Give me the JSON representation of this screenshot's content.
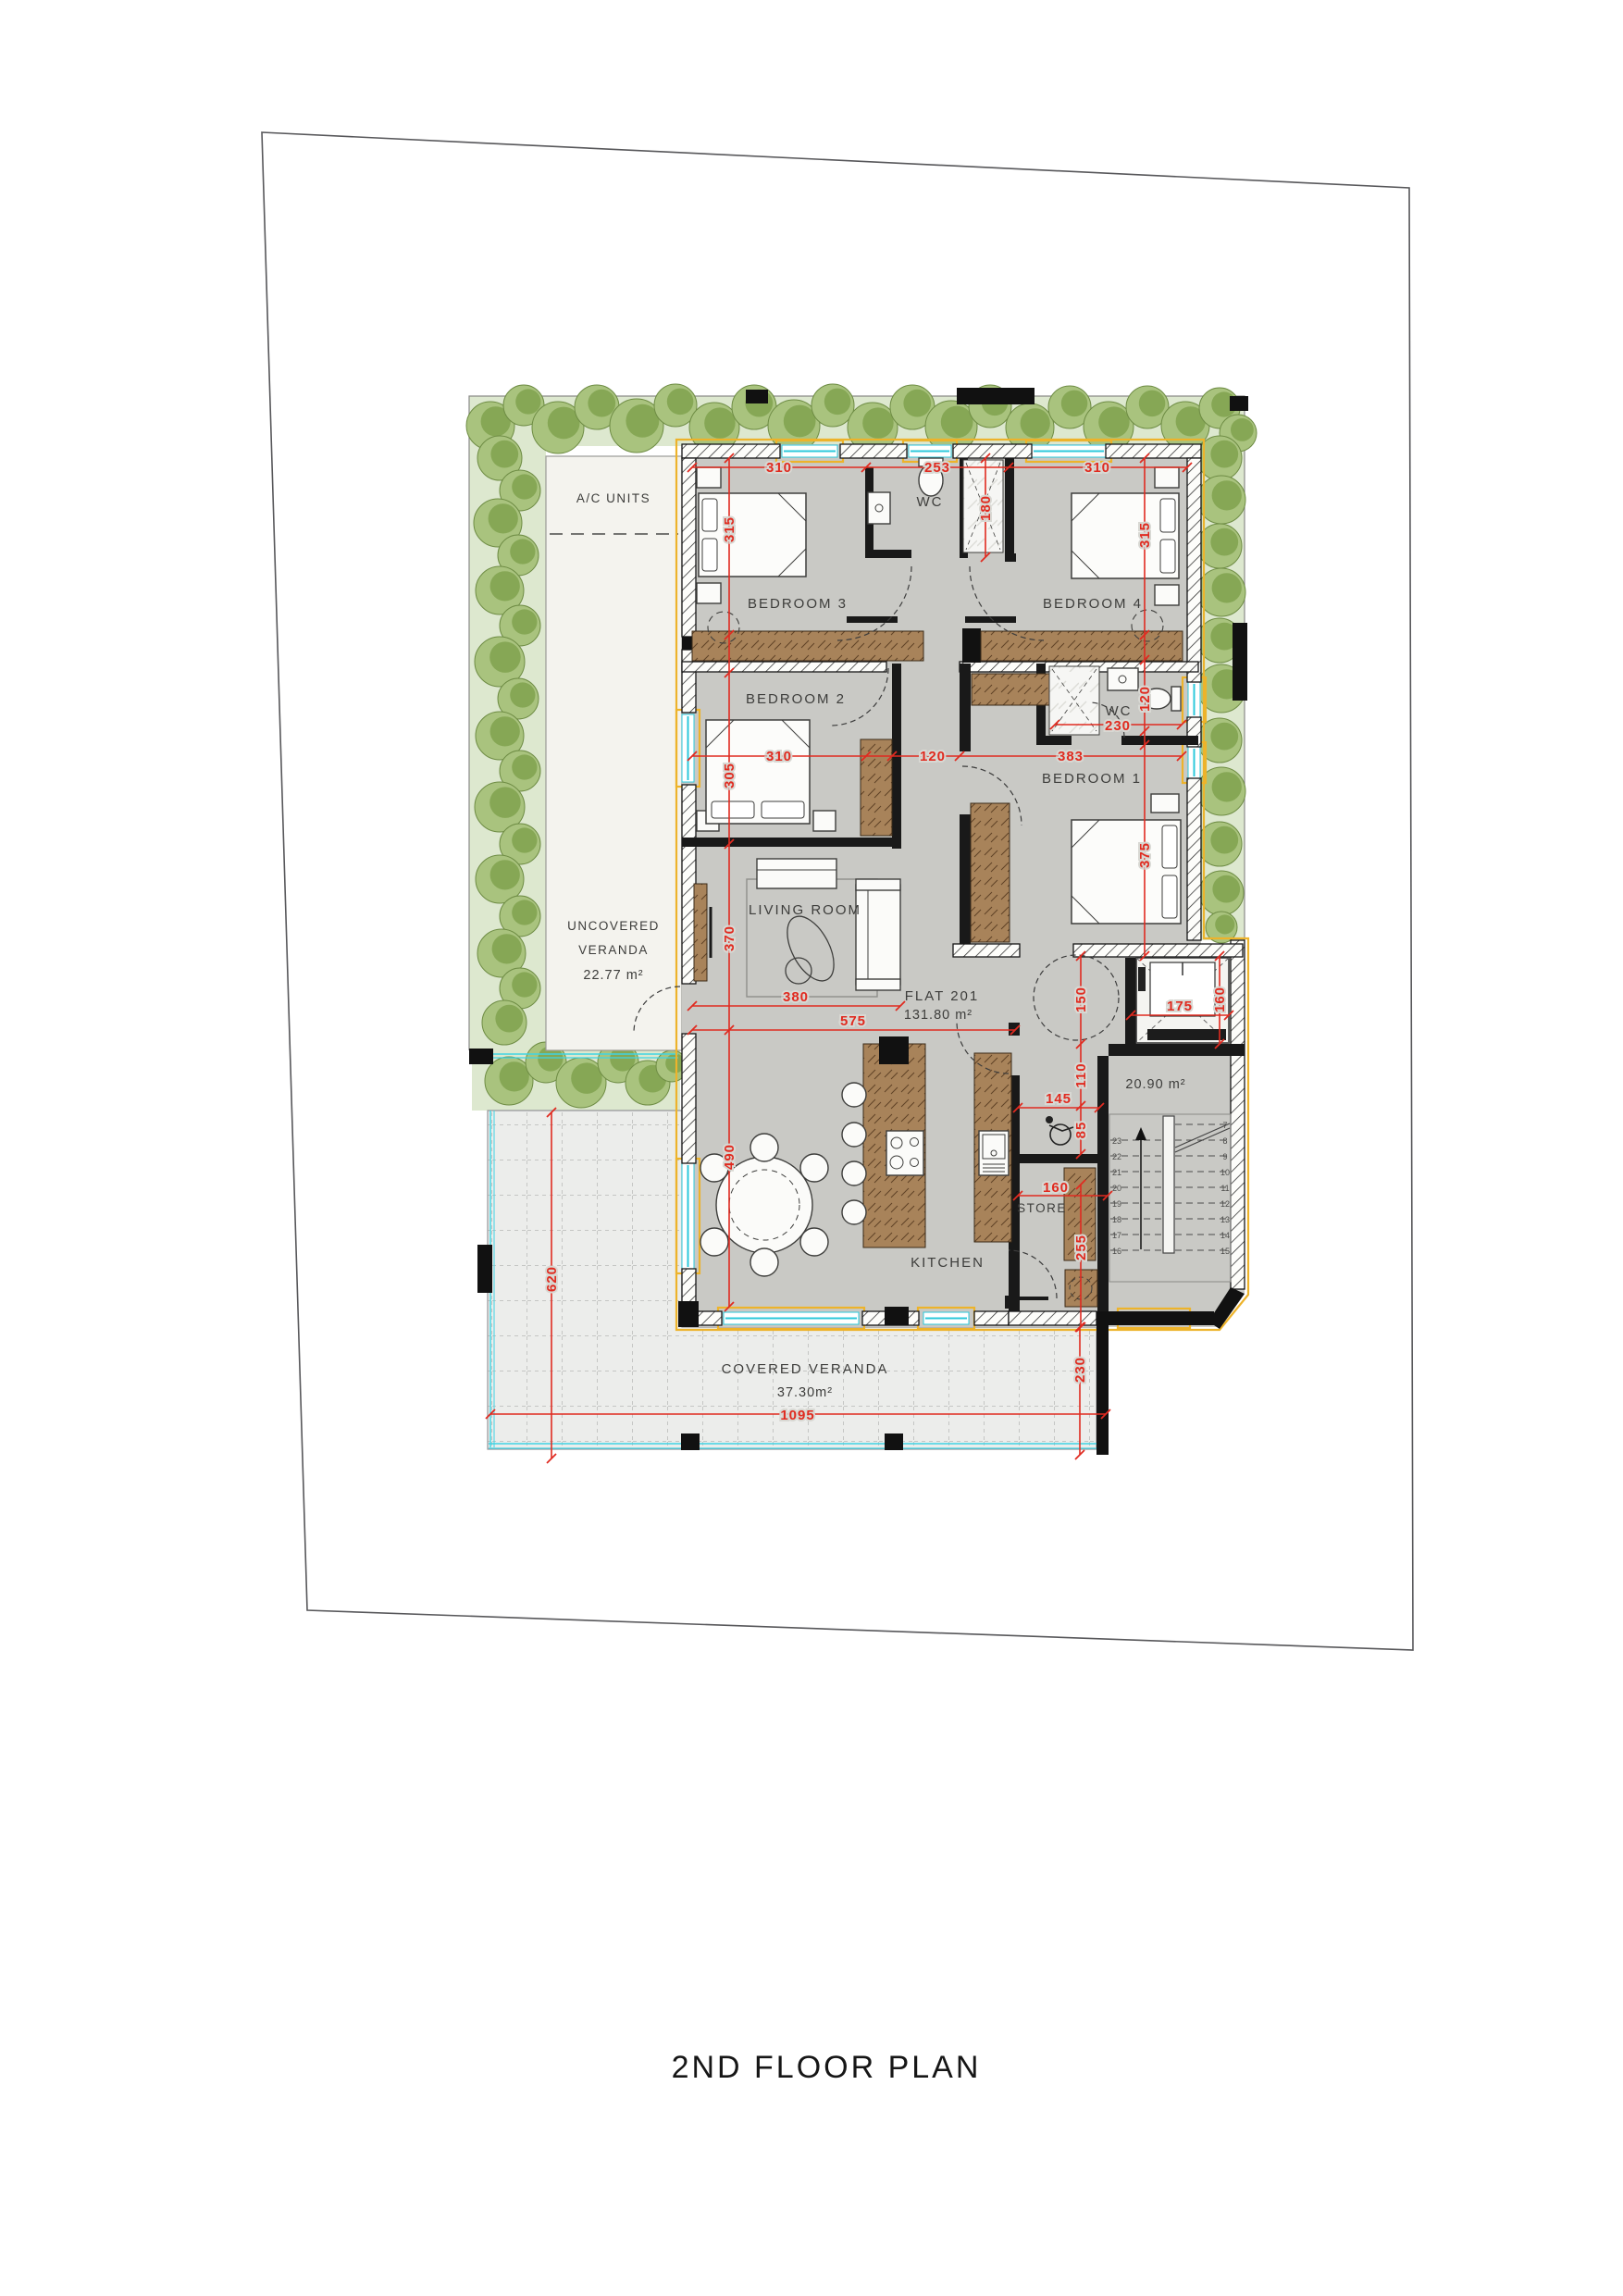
{
  "title": "2ND FLOOR PLAN",
  "flat": {
    "name": "FLAT 201",
    "area": "131.80 m²"
  },
  "rooms": {
    "bedroom1": "BEDROOM 1",
    "bedroom2": "BEDROOM 2",
    "bedroom3": "BEDROOM 3",
    "bedroom4": "BEDROOM 4",
    "living_room": "LIVING ROOM",
    "kitchen": "KITCHEN",
    "store": "STORE",
    "wc_top": "WC",
    "wc_right": "WC",
    "ac_units": "A/C UNITS",
    "uncovered_veranda": {
      "line1": "UNCOVERED",
      "line2": "VERANDA",
      "area": "22.77 m²"
    },
    "covered_veranda": {
      "label": "COVERED VERANDA",
      "area": "37.30m²"
    },
    "stair_hall": {
      "area": "20.90 m²"
    }
  },
  "dims": {
    "d310a": "310",
    "d253": "253",
    "d310b": "310",
    "d315a": "315",
    "d180": "180",
    "d315b": "315",
    "d230wc": "230",
    "d120wc": "120",
    "d310c": "310",
    "d120h": "120",
    "d383": "383",
    "d305": "305",
    "d375": "375",
    "d370": "370",
    "d380": "380",
    "d575": "575",
    "d150": "150",
    "d110": "110",
    "d85": "85",
    "d145": "145",
    "d160s": "160",
    "d255": "255",
    "d175": "175",
    "d160e": "160",
    "d490": "490",
    "d620": "620",
    "d1095": "1095",
    "d230v": "230"
  },
  "stairs": {
    "left_steps": [
      "23",
      "22",
      "21",
      "20",
      "19",
      "18",
      "17",
      "16"
    ],
    "right_steps": [
      "7",
      "8",
      "9",
      "10",
      "11",
      "12",
      "13",
      "14",
      "15"
    ]
  },
  "colors": {
    "dimension": "#e02b20",
    "window_glass": "#2cc8db",
    "window_frame": "#edb32b",
    "wood": "#a8835a",
    "tree_dark": "#7da04b",
    "tree_light": "#a9c37e",
    "garden_bg": "#dde8cf",
    "floor": "#c9c9c5",
    "veranda_floor": "#ecedeb"
  }
}
